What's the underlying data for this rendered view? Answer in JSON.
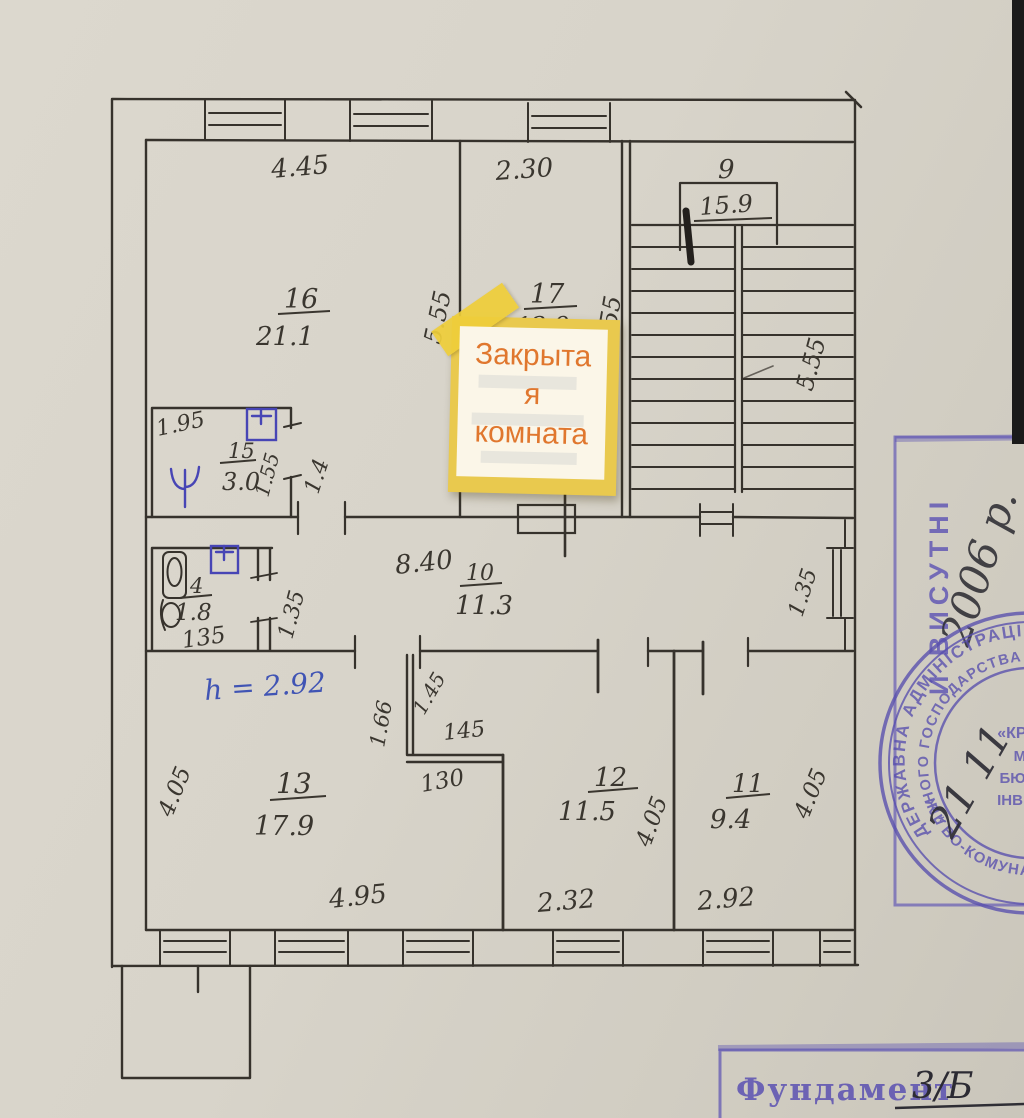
{
  "note": {
    "line1": "Закрыта",
    "line2": "я",
    "line3": "комната"
  },
  "rooms": {
    "r16": {
      "num": "16",
      "area": "21.1"
    },
    "r17": {
      "num": "17",
      "area": "12.9"
    },
    "r15": {
      "num": "15",
      "area": "3.0"
    },
    "r4": {
      "num": "4",
      "area": "1.8",
      "bottom": "135"
    },
    "r10": {
      "num": "10",
      "area": "11.3"
    },
    "r13": {
      "num": "13",
      "area": "17.9"
    },
    "r12": {
      "num": "12",
      "area": "11.5"
    },
    "r11": {
      "num": "11",
      "area": "9.4"
    },
    "stair": {
      "num": "9",
      "area": "15.9"
    }
  },
  "dims": {
    "top16": "4.45",
    "top17": "2.30",
    "side16": "5.55",
    "side17": "5.55",
    "sideStair": "5.55",
    "r15top": "1.95",
    "r15door": "1.55",
    "r15right": "1.4",
    "r4right": "1.35",
    "corridor": "8.40",
    "corridorRight": "1.35",
    "height": "h = 2.92",
    "r13left": "4.05",
    "r12right": "4.05",
    "r11right": "4.05",
    "notchLeft": "1.66",
    "notchRot": "1.45",
    "notchTop": "145",
    "notchBottom": "130",
    "bot13": "4.95",
    "bot12": "2.32",
    "bot11": "2.92"
  },
  "stamps": {
    "vertical": "И ВИСУТНІ",
    "year": "2006 р.",
    "date": "21 11",
    "round": {
      "ringOuter": "ДЕРЖАВНА АДМІНІСТРАЦІЯ * УКРА",
      "ringInner": "ЛЬНОГО ГОСПОДАРСТВА * КОМУНАЛЬНЕ",
      "ringBottom": "Ж * ВО-КОМУНАЛ * КОД 03",
      "line1": "«КРЕМЕН",
      "line2": "МІЖМ",
      "line3": "БЮРО ТЕ",
      "line4": "ІНВЕНТАР"
    },
    "foundationLabel": "Фундамент",
    "foundationValue": "3/Б"
  }
}
